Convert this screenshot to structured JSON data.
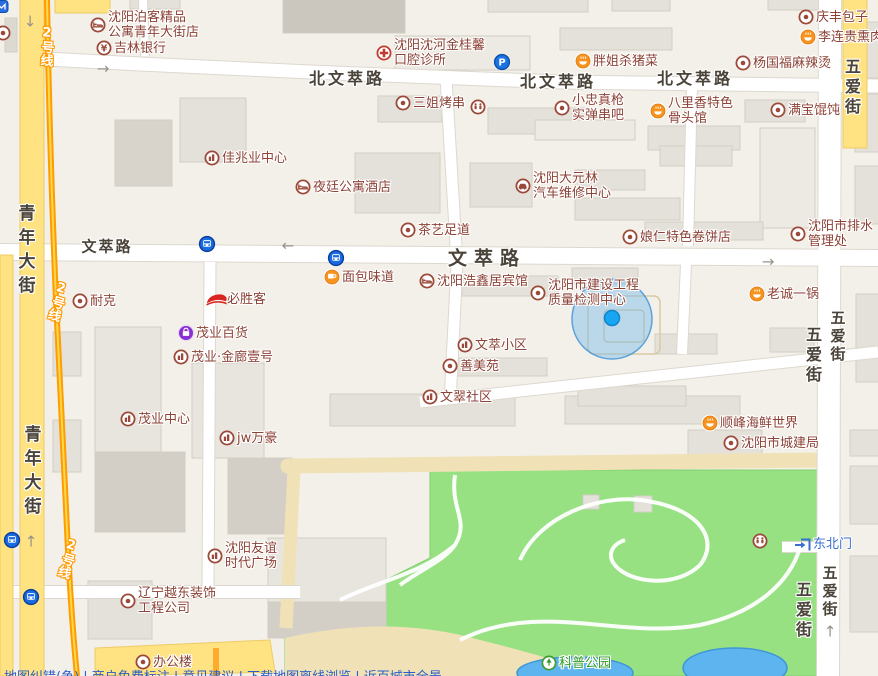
{
  "map": {
    "colors": {
      "background": "#f3f0e9",
      "poi_text": "#8c4236",
      "road_yellow": "#ffe282",
      "metro_orange": "#ff9c00",
      "park_green": "#97e183",
      "water_blue": "#5db4ee",
      "location_blue": "#18a6f2",
      "link_blue": "#2a5cc8"
    },
    "pois": [
      {
        "type": "metro-badge",
        "x": 2,
        "y": 7
      },
      {
        "type": "dot",
        "x": 3,
        "y": 33
      },
      {
        "type": "hotel",
        "x": 98,
        "y": 25,
        "lines": [
          "沈阳泊客精品",
          "公寓青年大街店"
        ]
      },
      {
        "type": "bank",
        "x": 104,
        "y": 48,
        "label": "吉林银行"
      },
      {
        "type": "hospital",
        "x": 384,
        "y": 53,
        "lines": [
          "沈阳沈河金桂馨",
          "口腔诊所"
        ]
      },
      {
        "type": "dot",
        "x": 403,
        "y": 103,
        "label": "三姐烤串"
      },
      {
        "type": "wc",
        "x": 478,
        "y": 107
      },
      {
        "type": "parking",
        "x": 502,
        "y": 62
      },
      {
        "type": "food",
        "x": 583,
        "y": 61,
        "label": "胖姐杀猪菜"
      },
      {
        "type": "dot",
        "x": 743,
        "y": 63,
        "label": "杨国福麻辣烫"
      },
      {
        "type": "dot",
        "x": 806,
        "y": 17,
        "label": "庆丰包子"
      },
      {
        "type": "food",
        "x": 808,
        "y": 37,
        "label": "李连贵熏肉大饼"
      },
      {
        "type": "dot",
        "x": 562,
        "y": 108,
        "lines": [
          "小忠真枪",
          "实弹串吧"
        ]
      },
      {
        "type": "food",
        "x": 658,
        "y": 111,
        "lines": [
          "八里香特色",
          "骨头馆"
        ]
      },
      {
        "type": "dot",
        "x": 778,
        "y": 110,
        "label": "满宝馄饨"
      },
      {
        "type": "building",
        "x": 212,
        "y": 158,
        "label": "佳兆业中心"
      },
      {
        "type": "hotel",
        "x": 303,
        "y": 187,
        "label": "夜廷公寓酒店"
      },
      {
        "type": "car",
        "x": 523,
        "y": 186,
        "lines": [
          "沈阳大元林",
          "汽车维修中心"
        ]
      },
      {
        "type": "dot",
        "x": 408,
        "y": 230,
        "label": "茶艺足道"
      },
      {
        "type": "dot",
        "x": 630,
        "y": 237,
        "label": "娘仁特色卷饼店"
      },
      {
        "type": "dot",
        "x": 798,
        "y": 234,
        "lines": [
          "沈阳市排水",
          "管理处"
        ]
      },
      {
        "type": "bus",
        "x": 207,
        "y": 244
      },
      {
        "type": "bus",
        "x": 336,
        "y": 258
      },
      {
        "type": "cafe",
        "x": 332,
        "y": 277,
        "label": "面包味道"
      },
      {
        "type": "hotel",
        "x": 427,
        "y": 281,
        "label": "沈阳浩鑫居宾馆"
      },
      {
        "type": "dot",
        "x": 538,
        "y": 293,
        "lines": [
          "沈阳市建设工程",
          "质量检测中心"
        ]
      },
      {
        "type": "food",
        "x": 757,
        "y": 294,
        "label": "老诚一锅"
      },
      {
        "type": "dot",
        "x": 80,
        "y": 301,
        "label": "耐克"
      },
      {
        "type": "pizzahut",
        "x": 217,
        "y": 299,
        "label": "必胜客"
      },
      {
        "type": "shopping",
        "x": 186,
        "y": 333,
        "label": "茂业百货"
      },
      {
        "type": "building",
        "x": 181,
        "y": 357,
        "label": "茂业·金廊壹号"
      },
      {
        "type": "building",
        "x": 465,
        "y": 345,
        "label": "文萃小区"
      },
      {
        "type": "dot",
        "x": 450,
        "y": 366,
        "label": "善美苑"
      },
      {
        "type": "building",
        "x": 430,
        "y": 397,
        "label": "文翠社区"
      },
      {
        "type": "building",
        "x": 128,
        "y": 419,
        "label": "茂业中心"
      },
      {
        "type": "building",
        "x": 227,
        "y": 438,
        "label": "jw万豪"
      },
      {
        "type": "food",
        "x": 710,
        "y": 423,
        "label": "顺峰海鲜世界"
      },
      {
        "type": "dot",
        "x": 731,
        "y": 443,
        "label": "沈阳市城建局"
      },
      {
        "type": "building",
        "x": 215,
        "y": 556,
        "lines": [
          "沈阳友谊",
          "时代广场"
        ]
      },
      {
        "type": "dot",
        "x": 128,
        "y": 601,
        "lines": [
          "辽宁越东装饰",
          "工程公司"
        ]
      },
      {
        "type": "dot",
        "x": 143,
        "y": 662,
        "label": "办公楼"
      },
      {
        "type": "wc",
        "x": 760,
        "y": 541
      },
      {
        "type": "gate",
        "x": 803,
        "y": 544,
        "label": "东北门",
        "color": "blue"
      },
      {
        "type": "park",
        "x": 549,
        "y": 663,
        "label": "科普公园",
        "color": "green"
      },
      {
        "type": "bus",
        "x": 12,
        "y": 540
      },
      {
        "type": "bus",
        "x": 31,
        "y": 597
      }
    ],
    "road_labels": [
      {
        "text": "北文萃路",
        "x": 347,
        "y": 77,
        "size": 16,
        "ls": 3
      },
      {
        "text": "北文萃路",
        "x": 558,
        "y": 80,
        "size": 16,
        "ls": 3
      },
      {
        "text": "北文萃路",
        "x": 695,
        "y": 77,
        "size": 16,
        "ls": 3
      },
      {
        "text": "文萃路",
        "x": 107,
        "y": 246,
        "size": 15,
        "ls": 2
      },
      {
        "text": "文萃路",
        "x": 487,
        "y": 257,
        "size": 19,
        "ls": 7
      },
      {
        "text": "青年大街",
        "x": 25,
        "y": 252,
        "size": 17,
        "ls": 7,
        "vertical": true
      },
      {
        "text": "青年大街",
        "x": 31,
        "y": 473,
        "size": 17,
        "ls": 7,
        "vertical": true
      },
      {
        "text": "五爱街",
        "x": 851,
        "y": 88,
        "size": 16,
        "ls": 4,
        "vertical": true
      },
      {
        "text": "五爱街",
        "x": 812,
        "y": 356,
        "size": 16,
        "ls": 4,
        "vertical": true
      },
      {
        "text": "五爱街",
        "x": 838,
        "y": 337,
        "size": 15,
        "ls": 3,
        "vertical": true
      },
      {
        "text": "五爱街",
        "x": 802,
        "y": 611,
        "size": 16,
        "ls": 4,
        "vertical": true
      },
      {
        "text": "五爱街",
        "x": 830,
        "y": 592,
        "size": 15,
        "ls": 3,
        "vertical": true
      }
    ],
    "metro_labels": [
      {
        "text": "2号线",
        "x": 46,
        "y": 46,
        "rot": 4
      },
      {
        "text": "2号线",
        "x": 57,
        "y": 301,
        "rot": 17
      },
      {
        "text": "2号线",
        "x": 67,
        "y": 558,
        "rot": 17
      }
    ],
    "arrows": [
      {
        "x": 30,
        "y": 22,
        "dir": "down"
      },
      {
        "x": 103,
        "y": 69,
        "dir": "right"
      },
      {
        "x": 288,
        "y": 246,
        "dir": "left"
      },
      {
        "x": 768,
        "y": 262,
        "dir": "right"
      },
      {
        "x": 31,
        "y": 542,
        "dir": "up"
      },
      {
        "x": 830,
        "y": 632,
        "dir": "up"
      }
    ],
    "footer": {
      "text": "地图纠错(争) | 商户免费标注 | 意见建议 | 下载地图离线浏览 | 近百城市全景"
    }
  }
}
